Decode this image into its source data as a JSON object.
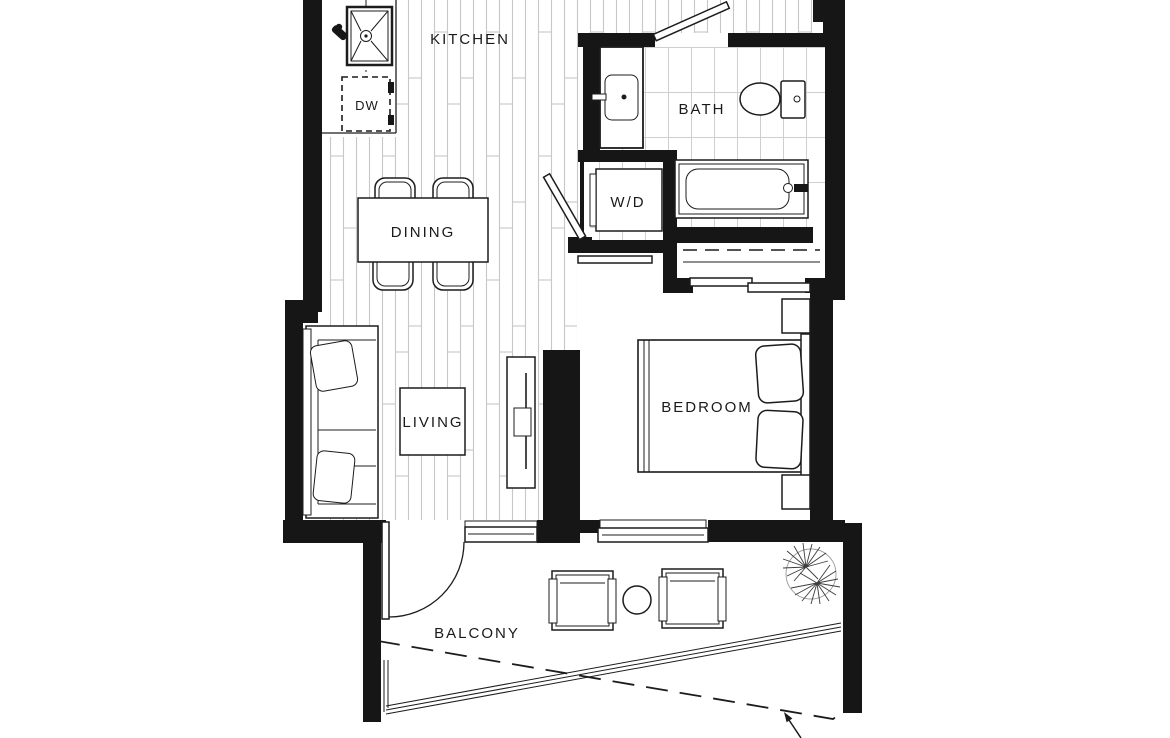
{
  "colors": {
    "wall": "#161616",
    "line": "#1c1c1c",
    "floorline": "#c7c7c7",
    "tileline": "#cfcfcf",
    "bg": "#ffffff"
  },
  "rooms": {
    "kitchen": {
      "label": "KITCHEN"
    },
    "bath": {
      "label": "BATH"
    },
    "dining": {
      "label": "DINING"
    },
    "living": {
      "label": "LIVING"
    },
    "bedroom": {
      "label": "BEDROOM"
    },
    "balcony": {
      "label": "BALCONY"
    }
  },
  "appliances": {
    "dishwasher": {
      "label": "DW"
    },
    "washer_dryer": {
      "label": "W/D"
    }
  }
}
